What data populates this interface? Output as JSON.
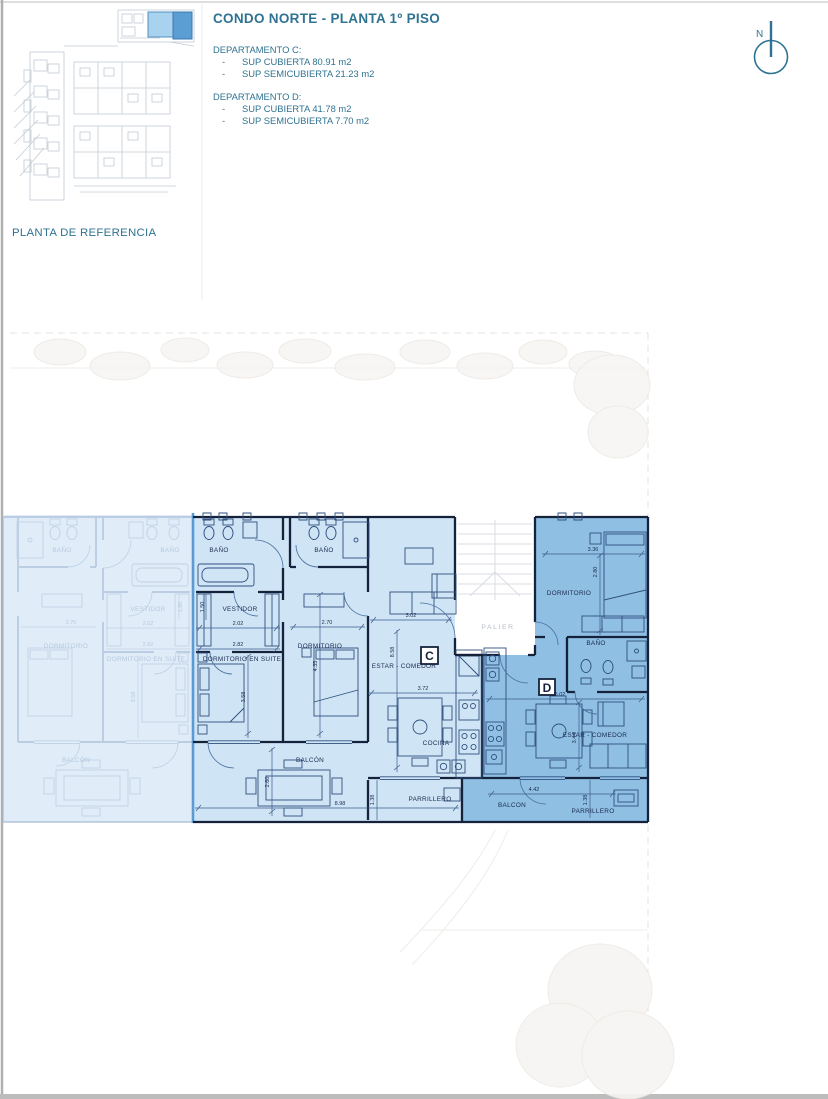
{
  "header": {
    "title": "CONDO NORTE - PLANTA 1º PISO",
    "bullet": "-",
    "departments": [
      {
        "name": "DEPARTAMENTO C:",
        "items": [
          "SUP CUBIERTA 80.91 m2",
          "SUP SEMICUBIERTA 21.23 m2"
        ]
      },
      {
        "name": "DEPARTAMENTO D:",
        "items": [
          "SUP CUBIERTA 41.78 m2",
          "SUP SEMICUBIERTA 7.70 m2"
        ]
      }
    ]
  },
  "reference_plan": {
    "caption": "PLANTA DE REFERENCIA"
  },
  "compass": {
    "north_label": "N"
  },
  "palier_label": "PALIER",
  "unit_c": {
    "letter": "C",
    "rooms": {
      "bano_left": "BAÑO",
      "bano_right": "BAÑO",
      "vestidor": "VESTIDOR",
      "dormitorio_en_suite": "DORMITORIO EN SUITE",
      "dormitorio": "DORMITORIO",
      "estar_comedor": "ESTAR - COMEDOR",
      "cocina": "COCINA",
      "balcon": "BALCÓN",
      "parrillero": "PARRILLERO"
    },
    "dims": {
      "vestidor_depth": "1.50",
      "vestidor_width": "2.02",
      "suite_width": "2.82",
      "suite_depth": "3.58",
      "dormitorio_width": "2.70",
      "dormitorio_depth": "4.35",
      "estar_width": "3.02",
      "estar_depth": "8.58",
      "comedor_width": "3.72",
      "balcon_depth": "2.60",
      "frente_total": "8.98",
      "parrillero_depth": "1.38"
    }
  },
  "unit_d": {
    "letter": "D",
    "rooms": {
      "dormitorio": "DORMITORIO",
      "bano": "BAÑO",
      "estar_comedor": "ESTAR - COMEDOR",
      "balcon": "BALCON",
      "parrillero": "PARRILLERO"
    },
    "dims": {
      "dormitorio_width": "3.36",
      "dormitorio_depth": "2.80",
      "estar_width": "5.02",
      "estar_depth": "3.44",
      "balcon_width": "4.42",
      "parrillero_depth": "1.38"
    }
  },
  "adjacent_unit": {
    "rooms": {
      "bano_left": "BAÑO",
      "bano_right": "BAÑO",
      "vestidor": "VESTIDOR",
      "dormitorio": "DORMITORIO",
      "dormitorio_en_suite": "DORMITORIO EN SUITE",
      "balcon": "BALCÓN"
    },
    "dims": {
      "dormitorio_width": "2.70",
      "vestidor_width": "2.02",
      "suite_width": "2.82",
      "suite_depth": "3.58",
      "vestidor_depth": "1.50"
    }
  },
  "colors": {
    "teal": "#2f7392",
    "unit_c_fill": "#cfe4f5",
    "unit_d_fill": "#8fbfe3",
    "adjacent_fill": "#e0edf9",
    "wall": "#15223c",
    "highlight_divider": "#5b9bd5",
    "thumb_highlight_light": "#a9d2ee",
    "thumb_highlight_dark": "#5b9ed4"
  }
}
